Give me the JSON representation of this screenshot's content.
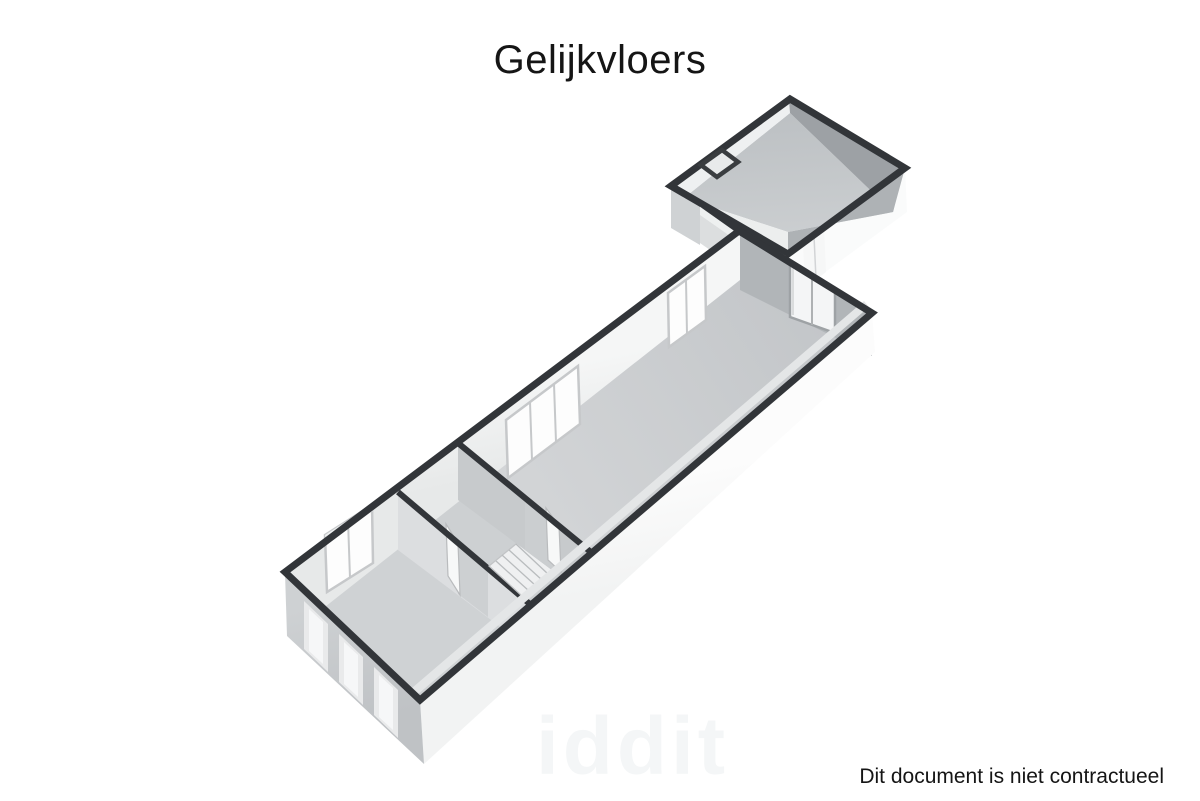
{
  "page": {
    "background": "#ffffff"
  },
  "title": "Gelijkvloers",
  "footer": {
    "disclaimer": "Dit document is niet contractueel"
  },
  "watermark": {
    "text": "iddit"
  },
  "floorplan": {
    "floor_name": "Gelijkvloers",
    "view": "3d-perspective-dollhouse",
    "palette": {
      "wall_cap": "#323539",
      "wall_interior_light": "#f2f3f3",
      "wall_interior_gray": "#b4b7ba",
      "facade_white": "#fbfbfb",
      "facade_gray": "#c9cccf",
      "floor_gray": "#cdd0d2",
      "window_white": "#fdfdfd"
    },
    "elements": {
      "rooms": [
        "front-room",
        "stair-room",
        "main-hall",
        "passage",
        "annex-room"
      ],
      "stairs": "straight stair along right wall of stair-room",
      "windows": [
        "double window front-room",
        "triple window main-hall",
        "double window main-hall end",
        "three facade windows on front gable"
      ],
      "doors": [
        "doorway front-room to stair-room",
        "doorway stair-room to main-hall",
        "glazed door at main-hall end",
        "doorway in annex rear wall"
      ],
      "shaft": "small square duct at annex west corner"
    }
  }
}
